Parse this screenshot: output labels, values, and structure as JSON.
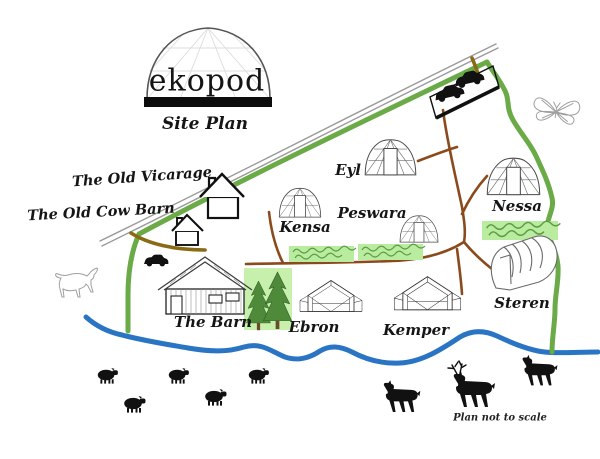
{
  "title": {
    "brand": "ekopod",
    "subtitle": "Site Plan"
  },
  "labels": {
    "old_vicarage": "The Old Vicarage",
    "old_cow_barn": "The Old Cow Barn",
    "the_barn": "The Barn",
    "eyl": "Eyl",
    "kensa": "Kensa",
    "peswara": "Peswara",
    "nessa": "Nessa",
    "steren": "Steren",
    "ebron": "Ebron",
    "kemper": "Kemper"
  },
  "footnote": "Plan not to scale",
  "colors": {
    "boundary_green": "#6aaa47",
    "track_brown": "#8b4a1b",
    "gate_olive": "#8a6a14",
    "river_blue": "#2a74c4",
    "road_gray": "#9a9a9a",
    "hedge_fill": "#b9ec9f",
    "hedge_scribble": "#5d9c45",
    "woodland_fill": "#c7f0ad",
    "tree_green": "#4e8a3a",
    "ink_black": "#111111",
    "sketch_gray": "#9f9f9f"
  },
  "icons": [
    "geodesic-dome-logo-icon",
    "house-icon",
    "barn-icon",
    "glamping-dome-icon",
    "lodge-tent-icon",
    "polytunnel-icon",
    "car-icon",
    "sheep-icon",
    "deer-icon",
    "stag-icon",
    "horse-icon",
    "butterfly-icon",
    "pine-tree-icon",
    "hedge-icon"
  ]
}
